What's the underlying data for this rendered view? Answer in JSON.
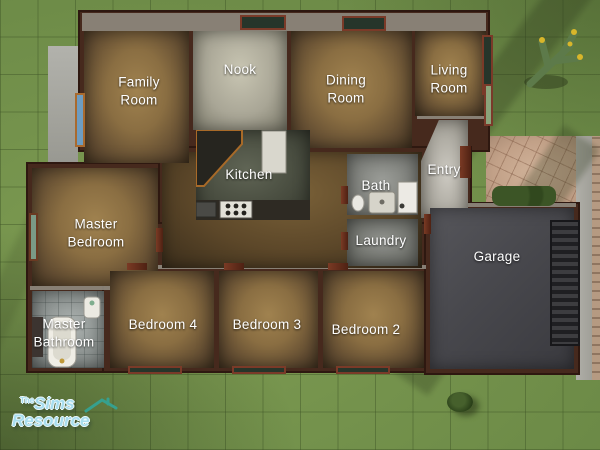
{
  "rooms": {
    "family_room": "Family Room",
    "nook": "Nook",
    "dining_room": "Dining Room",
    "living_room": "Living Room",
    "kitchen": "Kitchen",
    "bath": "Bath",
    "entry": "Entry",
    "laundry": "Laundry",
    "master_bedroom": "Master Bedroom",
    "master_bathroom": "Master Bathroom",
    "bedroom_4": "Bedroom 4",
    "bedroom_3": "Bedroom 3",
    "bedroom_2": "Bedroom 2",
    "garage": "Garage"
  },
  "watermark": {
    "prefix": "The",
    "word1": "Sims",
    "word2": "Resource"
  },
  "colors": {
    "grass": "#74924c",
    "wall": "#46291d",
    "carpet": "#8a6e42",
    "watermark_text": "#a8deef",
    "watermark_roof": "#36a08e",
    "label_text": "#ffffff"
  }
}
